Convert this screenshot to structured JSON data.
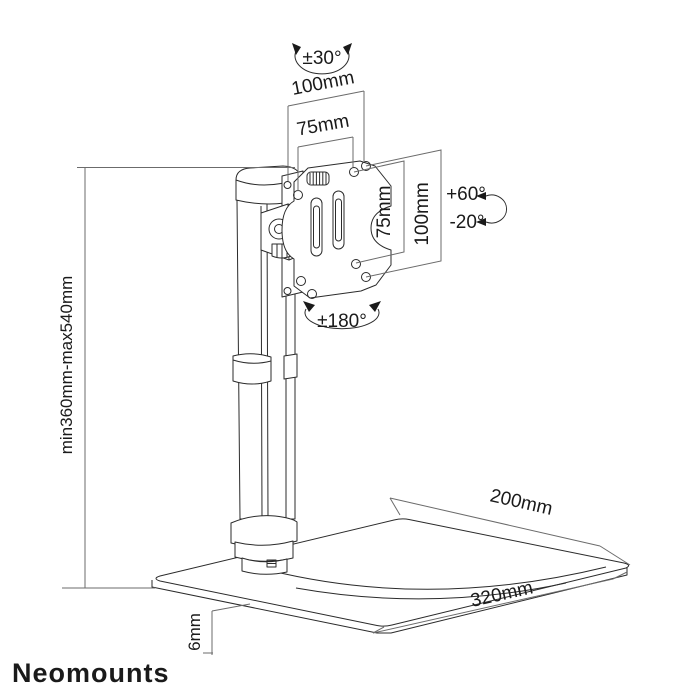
{
  "diagram": {
    "title_labels": {
      "swivel_top": "±30°",
      "vesa_width_outer": "100mm",
      "vesa_width_inner": "75mm",
      "vesa_height_inner": "75mm",
      "vesa_height_outer": "100mm",
      "tilt_up": "+60°",
      "tilt_down": "-20°",
      "rotation": "±180°",
      "height_range": "min360mm-max540mm",
      "base_depth": "200mm",
      "base_width": "320mm",
      "base_thickness": "6mm"
    },
    "colors": {
      "line": "#2b2b2b",
      "dimension_line": "#6b6b6b",
      "background": "#ffffff",
      "brand_gray": "#9b9b9b"
    }
  },
  "footer": {
    "brand": "Neomounts"
  }
}
